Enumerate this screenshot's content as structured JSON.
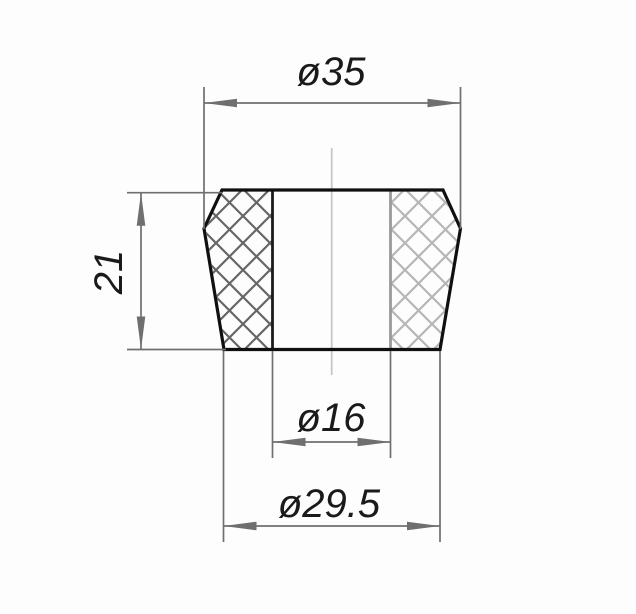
{
  "drawing": {
    "type": "technical-dimension-drawing",
    "view": "cross-section with crosshatched cut faces, tapered bushing",
    "dimensions": {
      "top_diameter": {
        "label": "ø35",
        "value": 35
      },
      "height": {
        "label": "21",
        "value": 21
      },
      "bore_diameter": {
        "label": "ø16",
        "value": 16
      },
      "bottom_diameter": {
        "label": "ø29.5",
        "value": 29.5
      }
    },
    "colors": {
      "background": "#fdfdfd",
      "outline": "#101010",
      "dimension": "#6f6f6f",
      "hatch_left": "#666666",
      "hatch_right": "#b6b6b6",
      "bore_left": "#1c1c1c",
      "bore_right": "#9a9a9a",
      "centerline": "#c6c6c6",
      "text": "#1a1a1a"
    }
  }
}
